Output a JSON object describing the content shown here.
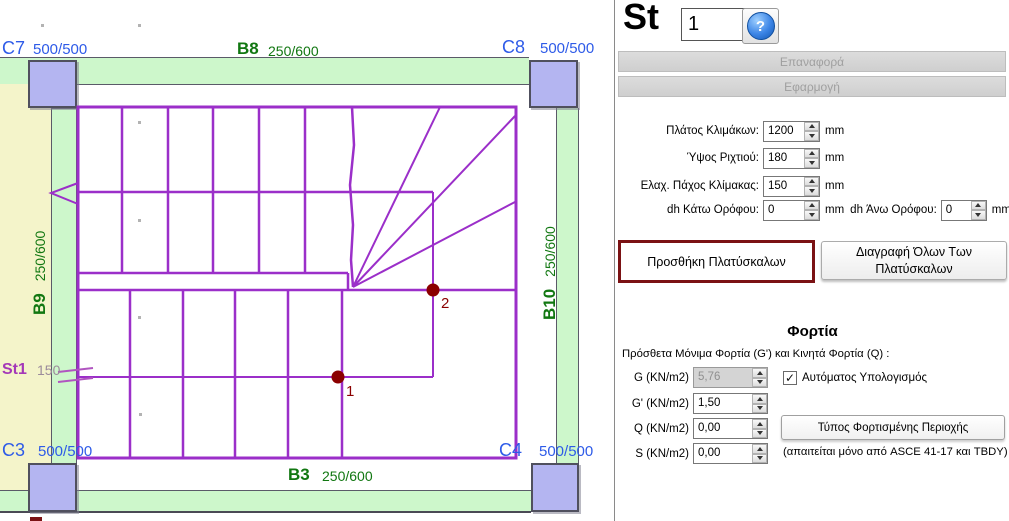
{
  "plan": {
    "columns": [
      {
        "id": "C7",
        "dim": "500/500"
      },
      {
        "id": "C8",
        "dim": "500/500"
      },
      {
        "id": "C3",
        "dim": "500/500"
      },
      {
        "id": "C4",
        "dim": "500/500"
      }
    ],
    "beams": [
      {
        "id": "B8",
        "dim": "250/600"
      },
      {
        "id": "B9",
        "dim": "250/600"
      },
      {
        "id": "B10",
        "dim": "250/600"
      },
      {
        "id": "B3",
        "dim": "250/600"
      }
    ],
    "stair": {
      "label": "St1",
      "thickness": "150"
    },
    "points": [
      {
        "label": "1"
      },
      {
        "label": "2"
      }
    ],
    "colors": {
      "column_fill": "#b4b5f1",
      "beam_fill": "#cdf7cb",
      "slab_fill": "#f4f4ca",
      "stair_line": "#9b2fc9",
      "column_label": "#2e5be8",
      "beam_label": "#117711",
      "point": "#8b0000"
    }
  },
  "panel": {
    "title": "St",
    "stair_number": "1",
    "icons": {
      "help": "?",
      "check": "✓"
    },
    "reset_label": "Επαναφορά",
    "apply_label": "Εφαρμογή",
    "fields": [
      {
        "label": "Πλάτος Κλιμάκων:",
        "value": "1200",
        "unit": "mm"
      },
      {
        "label": "Ύψος Ριχτιού:",
        "value": "180",
        "unit": "mm"
      },
      {
        "label": "Ελαχ. Πάχος Κλίμακας:",
        "value": "150",
        "unit": "mm"
      },
      {
        "label": "dh Κάτω Ορόφου:",
        "value": "0",
        "unit": "mm"
      },
      {
        "label": "dh Άνω Ορόφου:",
        "value": "0",
        "unit": "mm"
      }
    ],
    "add_landing_label": "Προσθήκη Πλατύσκαλων",
    "delete_landings_label": "Διαγραφή Όλων Των Πλατύσκαλων",
    "loads": {
      "heading": "Φορτία",
      "description": "Πρόσθετα Μόνιμα Φορτία (G') και Κινητά Φορτία (Q) :",
      "rows": [
        {
          "label": "G (KN/m2)",
          "value": "5,76"
        },
        {
          "label": "G' (KN/m2)",
          "value": "1,50"
        },
        {
          "label": "Q (KN/m2)",
          "value": "0,00"
        },
        {
          "label": "S (KN/m2)",
          "value": "0,00"
        }
      ],
      "auto_calc_label": "Αυτόματος Υπολογισμός",
      "load_area_type_label": "Τύπος Φορτισμένης Περιοχής",
      "note": "(απαιτείται μόνο από ASCE 41-17 και TBDY)"
    },
    "accent": {
      "highlight_border": "#7b1214"
    }
  }
}
